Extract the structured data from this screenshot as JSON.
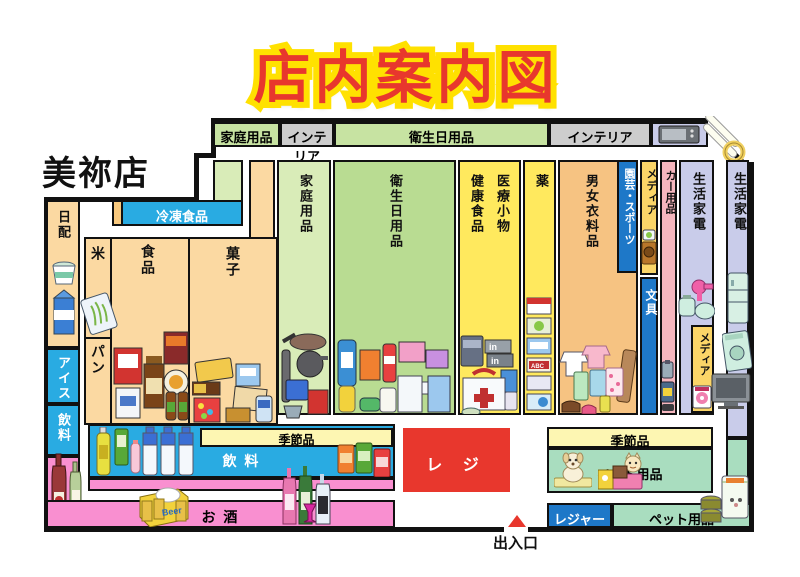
{
  "title": "店内案内図",
  "store_name": "美祢店",
  "entrance": {
    "label": "出入口"
  },
  "top_band": [
    "家庭用品",
    "インテリア",
    "衛生日用品",
    "インテリア"
  ],
  "areas": {
    "daily_dairy": "日配",
    "frozen_food": "冷凍食品",
    "ice_cream": "アイス",
    "beverage_left": "飲料",
    "rice": "米",
    "food": "食品",
    "bread": "パン",
    "confectionery": "菓子",
    "household_goods": "家庭用品",
    "sanitary_goods": "衛生日用品",
    "health_food": "健康食品",
    "medical_sundries": "医療小物",
    "medicine": "薬",
    "clothing": "男女衣料品",
    "garden_sports": "園芸・スポーツ",
    "media_upper": "メディア",
    "stationery": "文具",
    "car_goods": "カー用品",
    "home_appliance": "生活家電",
    "media_lower": "メディア",
    "home_appliance_right": "生活家電",
    "seasonal_left": "季節品",
    "beverage_bottom": "飲 料",
    "sake": "お 酒",
    "register": "レ ジ",
    "seasonal_right": "季節品",
    "pet_goods": "ペット用品",
    "leisure": "レジャー",
    "pet_goods_bottom": "ペット用品"
  },
  "colors": {
    "register_red": "#E8372D",
    "title_red": "#E8372D",
    "title_yellow": "#FFE100",
    "cyan_blue": "#29ABE2",
    "deep_blue": "#1E78C8",
    "magenta_pink": "#F98FD0",
    "soft_pink": "#F5B6BE",
    "purple": "#C9CCEA",
    "mint_green": "#A9DDBF",
    "food_orange": "#FBD9A2",
    "clothing_orange": "#F6C382",
    "green": "#B9DC92",
    "light_green": "#D9ECB8",
    "column_yellow": "#FFE95E",
    "media_yellow": "#FBD568",
    "seasonal_yellow": "#FDF6B2",
    "interior_gray": "#CDCDCD"
  },
  "icons": [
    "dairy-icon",
    "rice-bag-icon",
    "food-cluster-icon",
    "snack-cluster-icon",
    "kitchenware-icon",
    "hygiene-cluster-icon",
    "first-aid-icon",
    "medicine-boxes-icon",
    "clothes-cluster-icon",
    "camera-icon",
    "car-spray-icon",
    "small-appliance-icon",
    "dvd-icon",
    "fridge-icon",
    "washer-icon",
    "tv-icon",
    "microwave-icon",
    "light-tubes-icon",
    "drink-bottles-icon",
    "pet-bottles-icon",
    "cans-icon",
    "beer-crate-icon",
    "sake-bottles-icon",
    "wine-bottles-icon",
    "dog-icon",
    "cat-icon",
    "pet-food-icon",
    "entrance-arrow-icon"
  ]
}
